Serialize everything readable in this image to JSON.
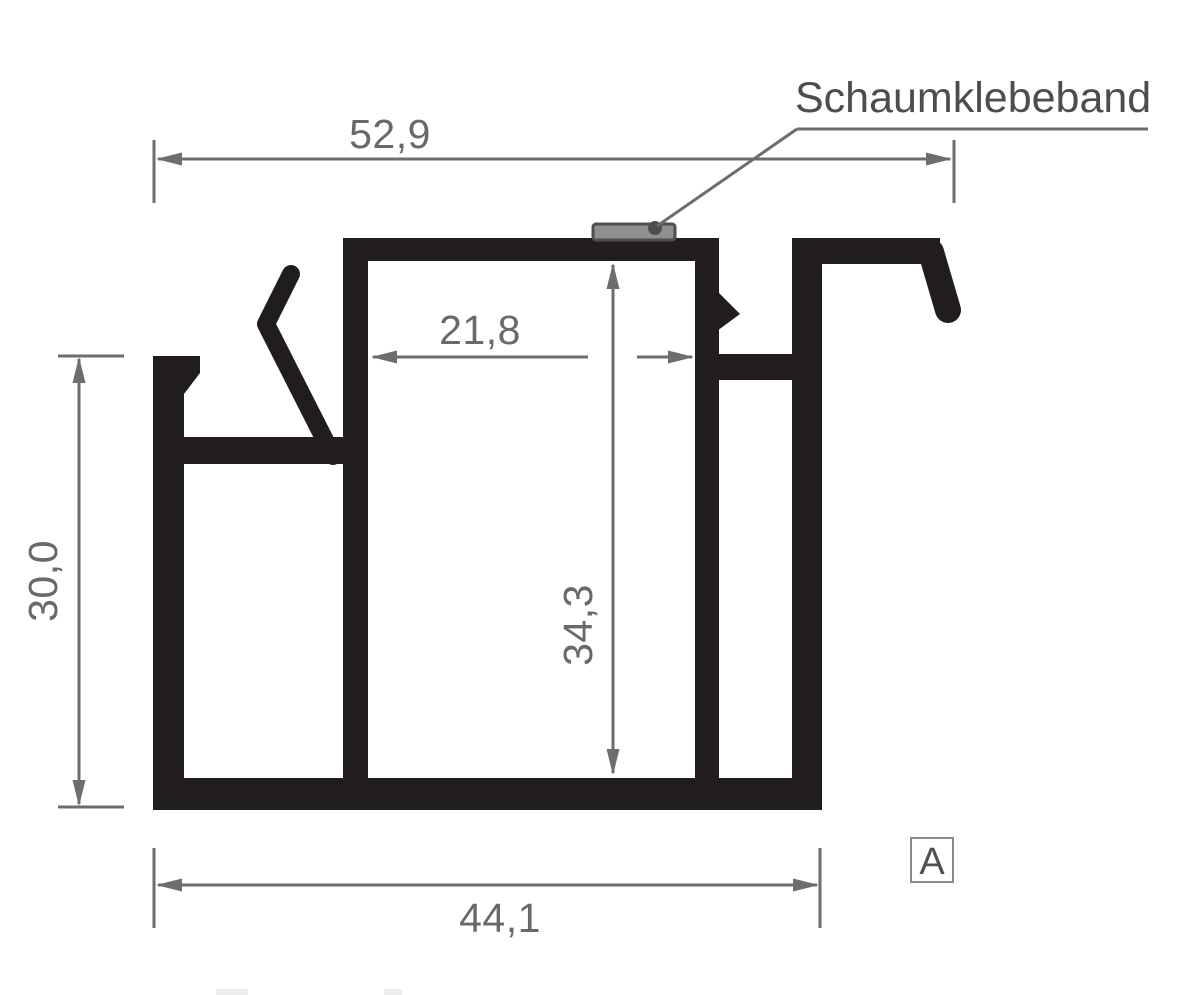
{
  "drawing": {
    "kind": "aluminium-profile-cross-section",
    "annotation": {
      "label": "Schaumklebeband"
    },
    "detail_marker": {
      "label": "A"
    },
    "dimensions": {
      "top_width": "52,9",
      "inner_width": "21,8",
      "left_height": "30,0",
      "inner_height": "34,3",
      "bottom_width": "44,1"
    },
    "colors": {
      "background": "#ffffff",
      "profile": "#211d1d",
      "dimension": "#6d6d6d",
      "dimension_text": "#696969",
      "annotation_text": "#4d4d4d",
      "tape_fill": "#8f8f8f",
      "tape_border": "#4e4e4e",
      "marker_border": "#8a8a8a",
      "marker_text": "#4f4f4f",
      "artifact": "#ececec"
    }
  }
}
